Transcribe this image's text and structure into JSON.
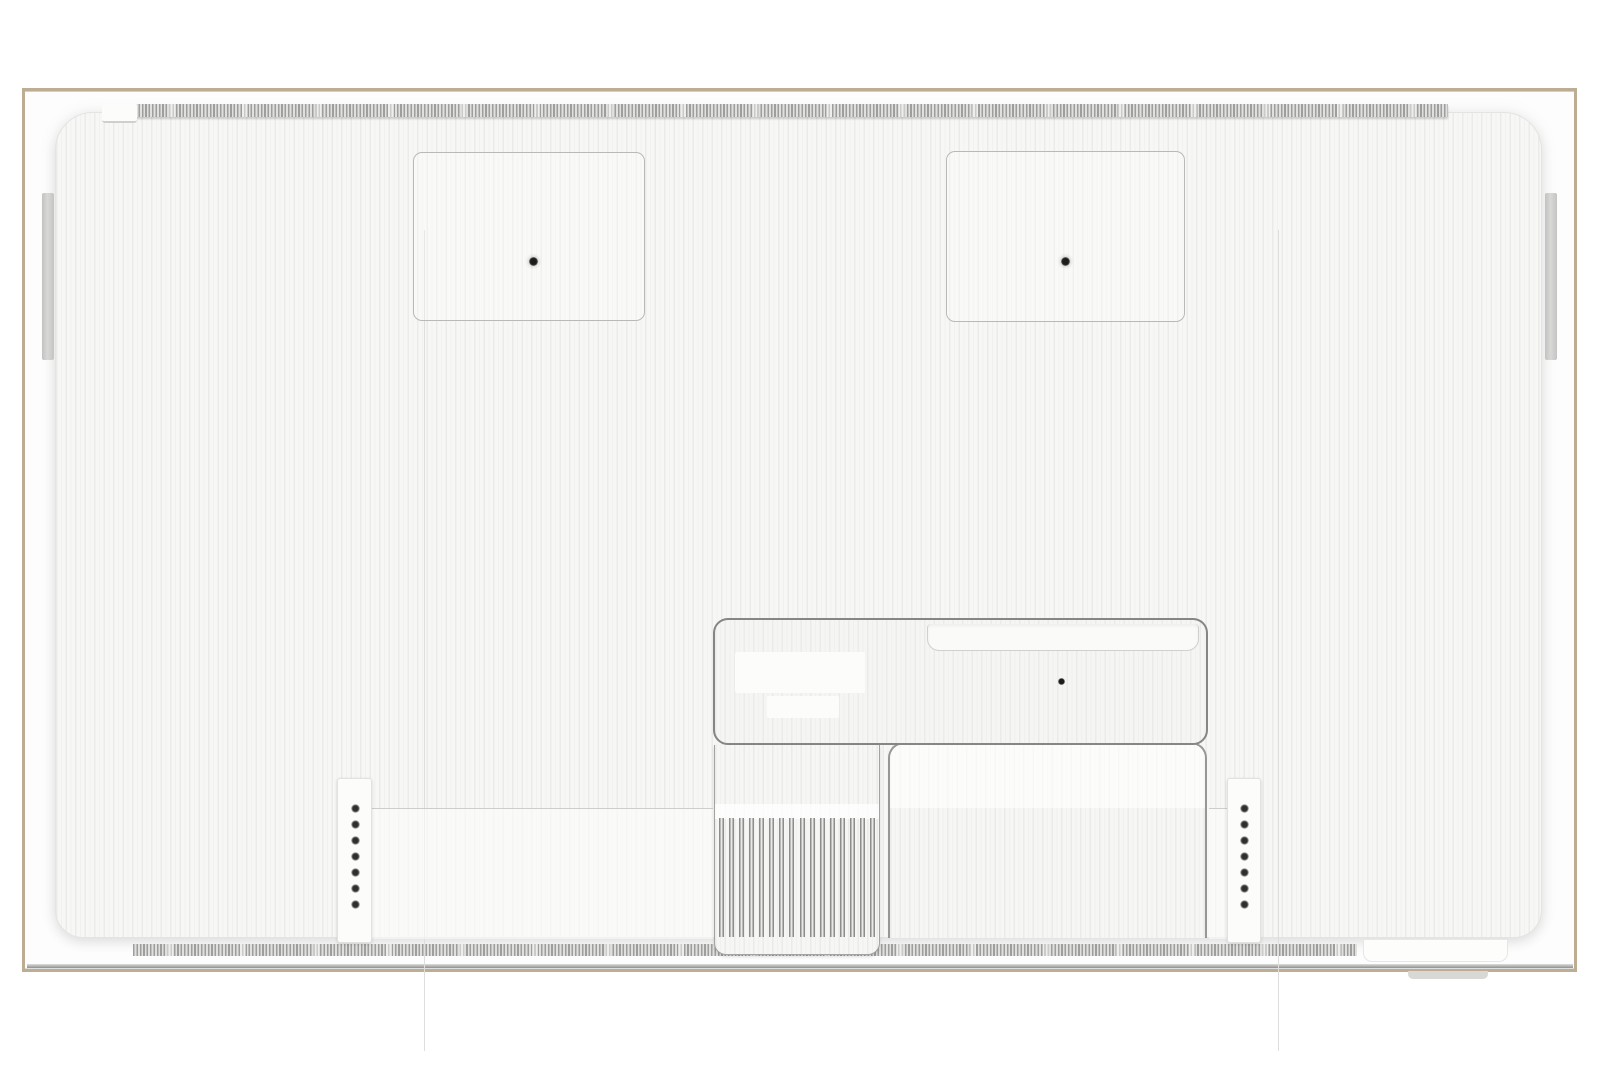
{
  "scene": {
    "type": "product-photo",
    "subject": "rear view of a wall-mountable flat-panel TV with ribbed back cover",
    "background": "white",
    "visible_text": ""
  },
  "colors": {
    "page_bg": "#ffffff",
    "frame_border": "#bdad93",
    "frame_fill": "#fdfdfd",
    "panel_base": "#f7f7f6",
    "panel_stripe": "#ebebe9",
    "seam": "#dededc",
    "outline_dark": "#868684",
    "outline_mid": "#a3a3a1",
    "ridge_dark": "#9e9e9c",
    "ridge_light": "#e0e0de",
    "band_line": "#cdcdcb",
    "plate": "#fcfcfb",
    "hole_black": "#1c1c1c",
    "screw_gray": "#6f6f6d"
  },
  "counts": {
    "vesa_recesses": 2,
    "vesa_holes_per_recess": 1,
    "screw_strips": 2,
    "holes_per_screw_strip": 7,
    "vent_ribs": 16,
    "panel_seams": 2,
    "side_bars": 2
  }
}
